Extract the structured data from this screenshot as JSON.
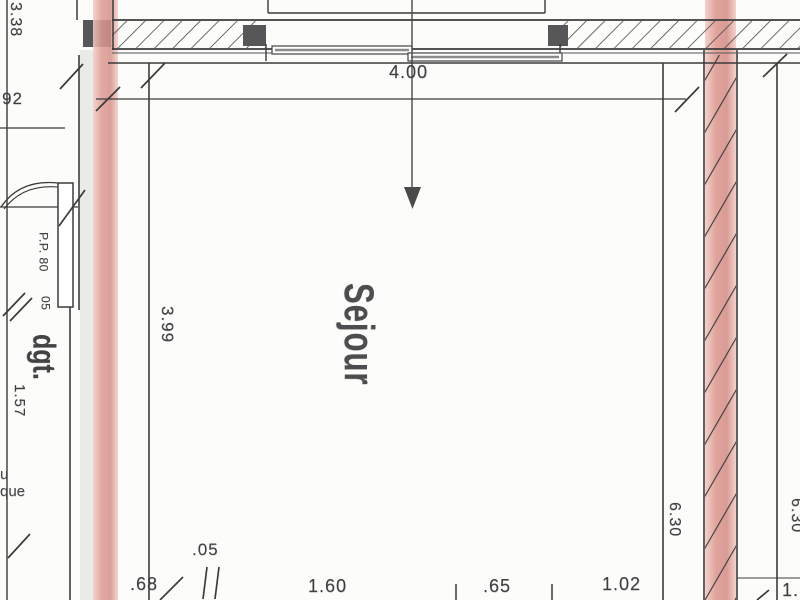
{
  "plan": {
    "labels": {
      "room": "Sejour",
      "corridor": "dgt.",
      "door": "P.P. 80",
      "clipped_word_top": "u",
      "clipped_word_bottom": "que"
    },
    "dims": {
      "window_width": "4.00",
      "room_left": "3.99",
      "corridor_length": "3.38",
      "corridor_width": "92",
      "corridor_inner": "1.57",
      "door_jamb": "05",
      "right_inner": "6.30",
      "right_outer": "6.30",
      "bottom_1": ".68",
      "bottom_2": ".05",
      "bottom_3": "1.60",
      "bottom_4": ".65",
      "bottom_5": "1.02",
      "bottom_6": "1."
    },
    "colors": {
      "wall_pink": "#dd9a92",
      "wall_pink_light": "#f3cdc7",
      "ink": "#3b3b3b",
      "block": "#57575a",
      "text": "#3f3f42"
    }
  }
}
